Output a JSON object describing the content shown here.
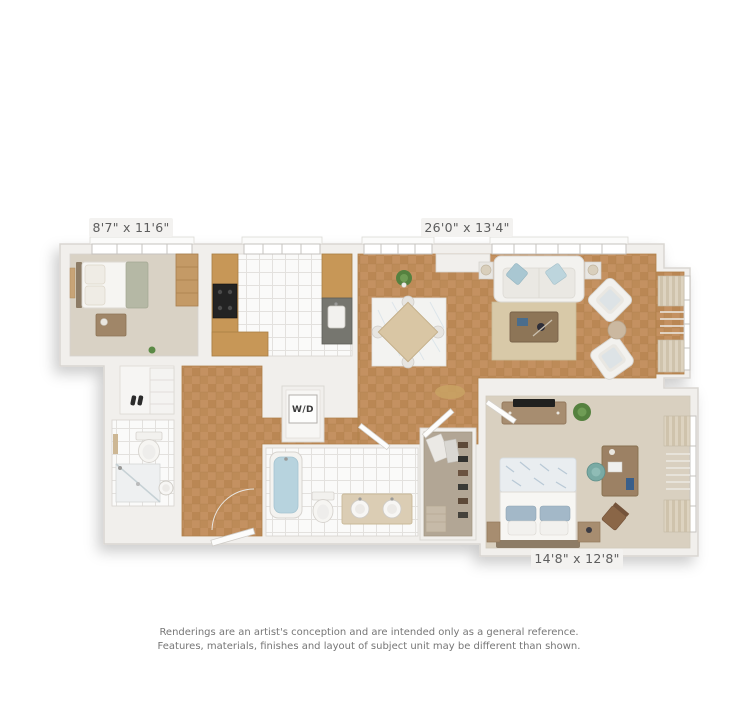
{
  "floorplan": {
    "room_labels": {
      "small_bedroom_dimensions": "8'7\" x 11'6\"",
      "living_room_dimensions": "26'0\" x 13'4\"",
      "master_bedroom_dimensions": "14'8\" x 12'8\"",
      "washer_dryer_label": "W/D"
    },
    "rooms_visible": [
      "small bedroom",
      "kitchen",
      "dining area",
      "living room",
      "hallway",
      "washer-dryer closet",
      "main bathroom",
      "walk-in closet",
      "master bedroom",
      "second bathroom",
      "entry closet"
    ],
    "palette": {
      "background": "#ffffff",
      "wall": "#f1efec",
      "wall_edge": "#d9d6d1",
      "wood_floor": "#c49161",
      "carpet_small_bedroom": "#d9d2c5",
      "carpet_master_bedroom": "#d9d0c0",
      "tile_floor": "#fafaf9",
      "cabinet_wood": "#c79757",
      "tub_water": "#b7d3de",
      "accent_pillow_blue": "#a3b8c8",
      "label_text": "#5d5d5d",
      "disclaimer_text": "#767676"
    }
  },
  "disclaimer": {
    "line1": "Renderings are an artist's conception and are intended only as a general reference.",
    "line2": "Features, materials, finishes and layout of subject unit may be different than shown."
  }
}
